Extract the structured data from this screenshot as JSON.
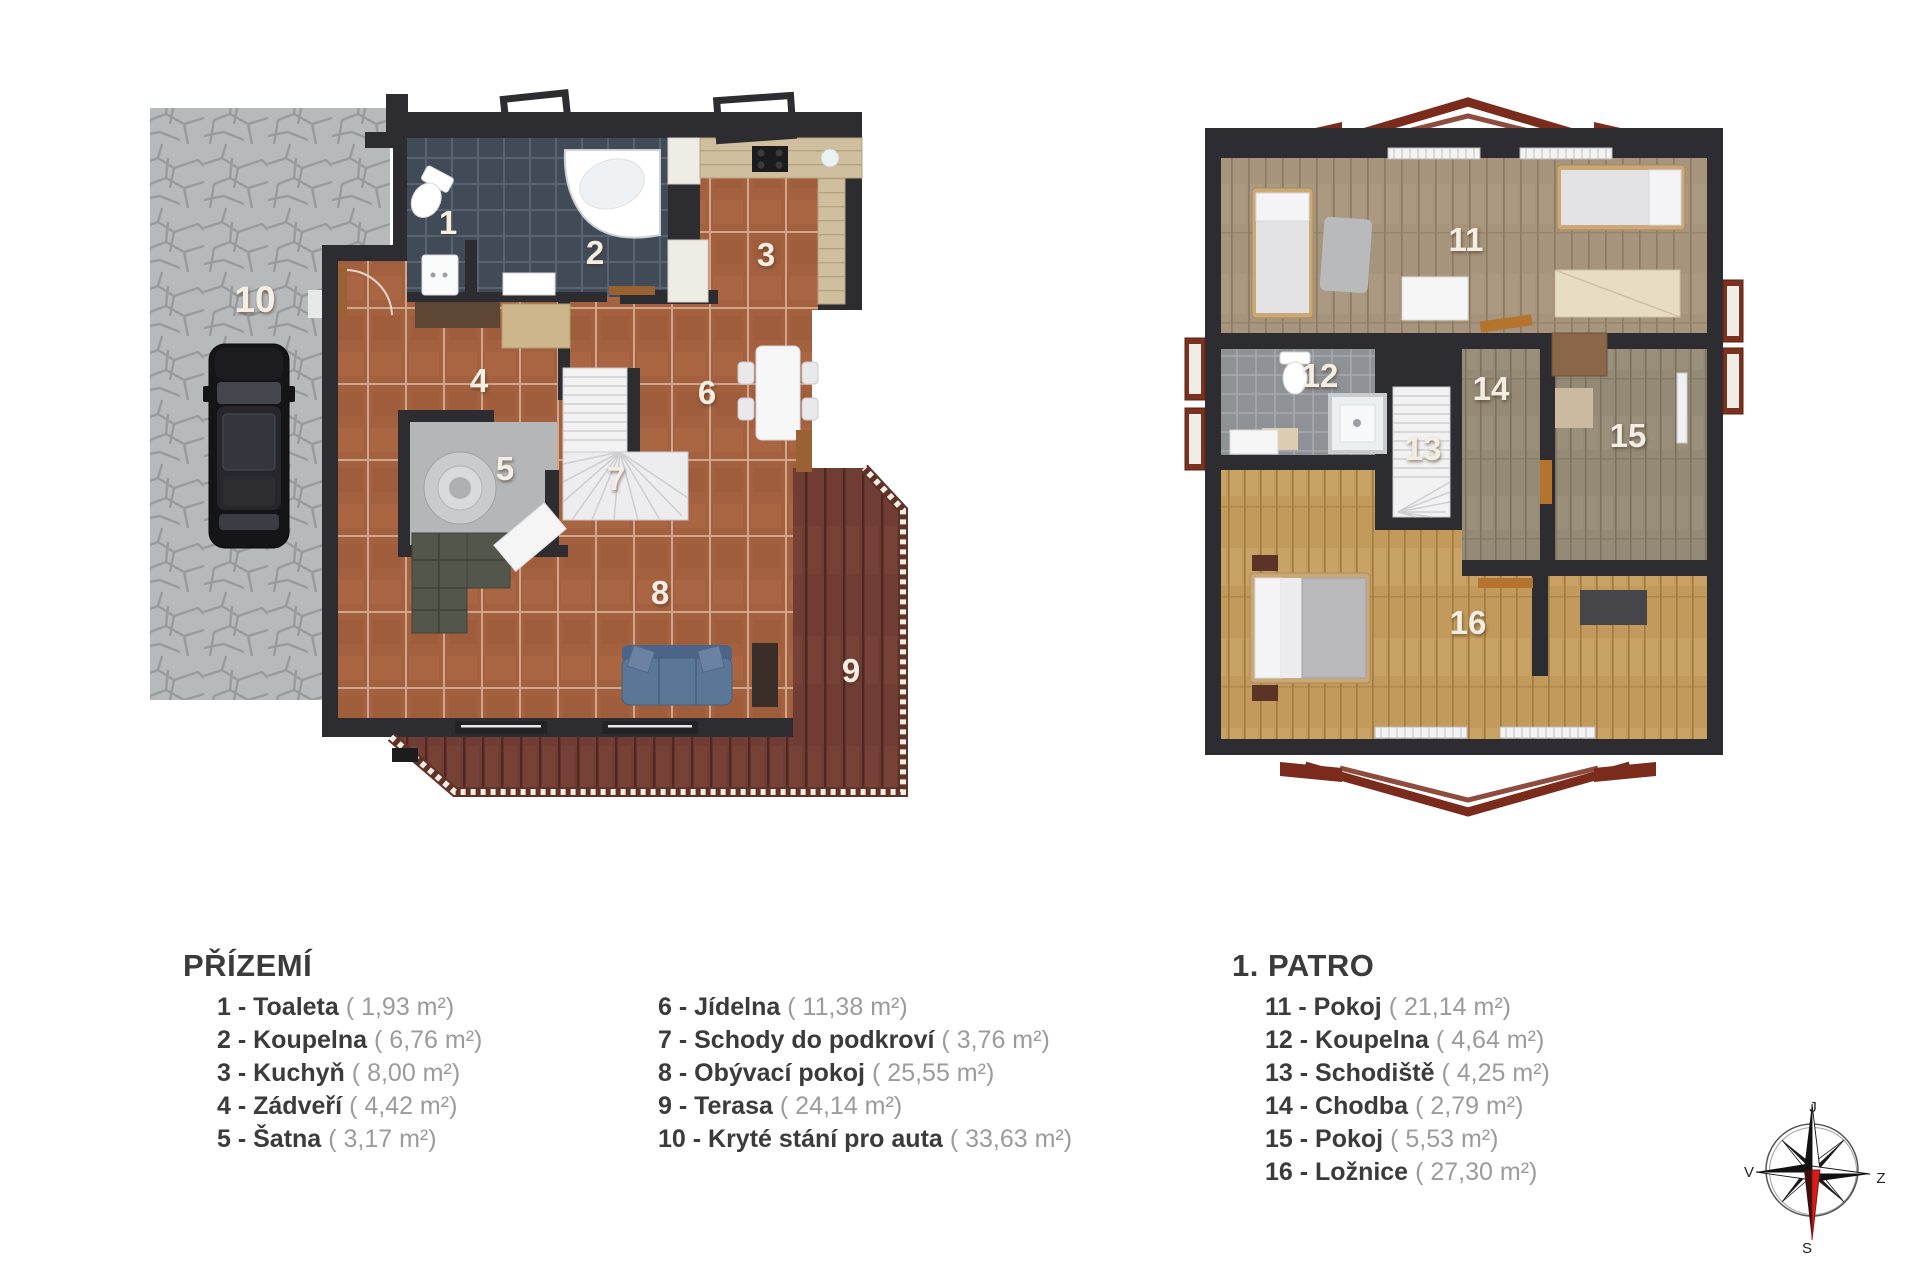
{
  "floors": {
    "ground": {
      "title": "PŘÍZEMÍ",
      "rooms": [
        {
          "num": "1",
          "name": "Toaleta",
          "legend_label": "1 - Toaleta",
          "area_label": "( 1,93 m²)"
        },
        {
          "num": "2",
          "name": "Koupelna",
          "legend_label": "2 - Koupelna",
          "area_label": "( 6,76 m²)"
        },
        {
          "num": "3",
          "name": "Kuchyň",
          "legend_label": "3 - Kuchyň",
          "area_label": "( 8,00 m²)"
        },
        {
          "num": "4",
          "name": "Zádveří",
          "legend_label": "4 - Zádveří",
          "area_label": "( 4,42 m²)"
        },
        {
          "num": "5",
          "name": "Šatna",
          "legend_label": "5 - Šatna",
          "area_label": "( 3,17 m²)"
        },
        {
          "num": "6",
          "name": "Jídelna",
          "legend_label": "6 - Jídelna",
          "area_label": "( 11,38 m²)"
        },
        {
          "num": "7",
          "name": "Schody do podkroví",
          "legend_label": "7 - Schody do podkroví",
          "area_label": "( 3,76 m²)"
        },
        {
          "num": "8",
          "name": "Obývací pokoj",
          "legend_label": "8 - Obývací pokoj",
          "area_label": "( 25,55 m²)"
        },
        {
          "num": "9",
          "name": "Terasa",
          "legend_label": "9 - Terasa",
          "area_label": "( 24,14 m²)"
        },
        {
          "num": "10",
          "name": "Kryté stání pro auta",
          "legend_label": "10 - Kryté stání pro auta",
          "area_label": "( 33,63 m²)"
        }
      ]
    },
    "upper": {
      "title": "1. PATRO",
      "rooms": [
        {
          "num": "11",
          "name": "Pokoj",
          "legend_label": "11 - Pokoj",
          "area_label": "( 21,14 m²)"
        },
        {
          "num": "12",
          "name": "Koupelna",
          "legend_label": "12 - Koupelna",
          "area_label": "( 4,64 m²)"
        },
        {
          "num": "13",
          "name": "Schodiště",
          "legend_label": "13 - Schodiště",
          "area_label": "( 4,25 m²)"
        },
        {
          "num": "14",
          "name": "Chodba",
          "legend_label": "14 - Chodba",
          "area_label": "( 2,79 m²)"
        },
        {
          "num": "15",
          "name": "Pokoj",
          "legend_label": "15 - Pokoj",
          "area_label": "( 5,53 m²)"
        },
        {
          "num": "16",
          "name": "Ložnice",
          "legend_label": "16 - Ložnice",
          "area_label": "( 27,30 m²)"
        }
      ]
    }
  },
  "compass": {
    "top": "J",
    "left": "V",
    "right": "Z",
    "bottom": "S"
  },
  "colors": {
    "wall": "#2d2c31",
    "terracotta_tile": "#a4613f",
    "bath_tile": "#414b58",
    "stone_paving": "#b7babb",
    "terrace_wood": "#6f3d33",
    "upper_wood": "#a6947c",
    "bedroom_wood": "#c29a5c",
    "legend_name": "#3b3b3b",
    "legend_area": "#9b9b9b",
    "compass_red": "#cf1f1a"
  }
}
